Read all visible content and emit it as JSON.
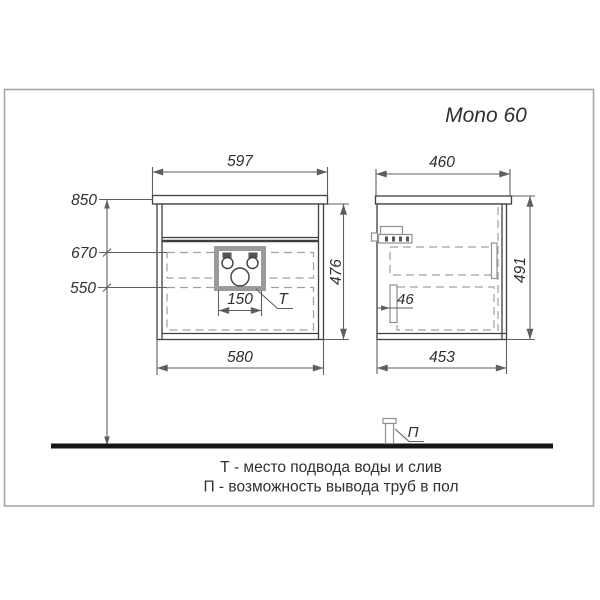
{
  "title": "Mono 60",
  "front_view": {
    "top_width": "597",
    "bottom_width": "580",
    "height": "476",
    "level_countertop": "850",
    "level_connection_top": "670",
    "level_connection_bottom": "550",
    "connection_box_width": "150",
    "connection_label": "T"
  },
  "side_view": {
    "top_depth": "460",
    "bottom_depth": "453",
    "height": "491",
    "slide_offset": "46"
  },
  "floor": {
    "pipe_label": "П"
  },
  "legend": {
    "line1": "Т - место подвода  воды и слив",
    "line2": "П - возможность вывода труб в пол"
  },
  "colors": {
    "background": "#ffffff",
    "ink": "#3f3f3f",
    "dim_lines": "#5f5f5f",
    "dashed": "#a0a0a0",
    "frame": "#a6a6a6",
    "floor": "#161616",
    "text": "#303030",
    "hardware": "#8f8f8f",
    "connection_box": "#9a9a9a"
  }
}
